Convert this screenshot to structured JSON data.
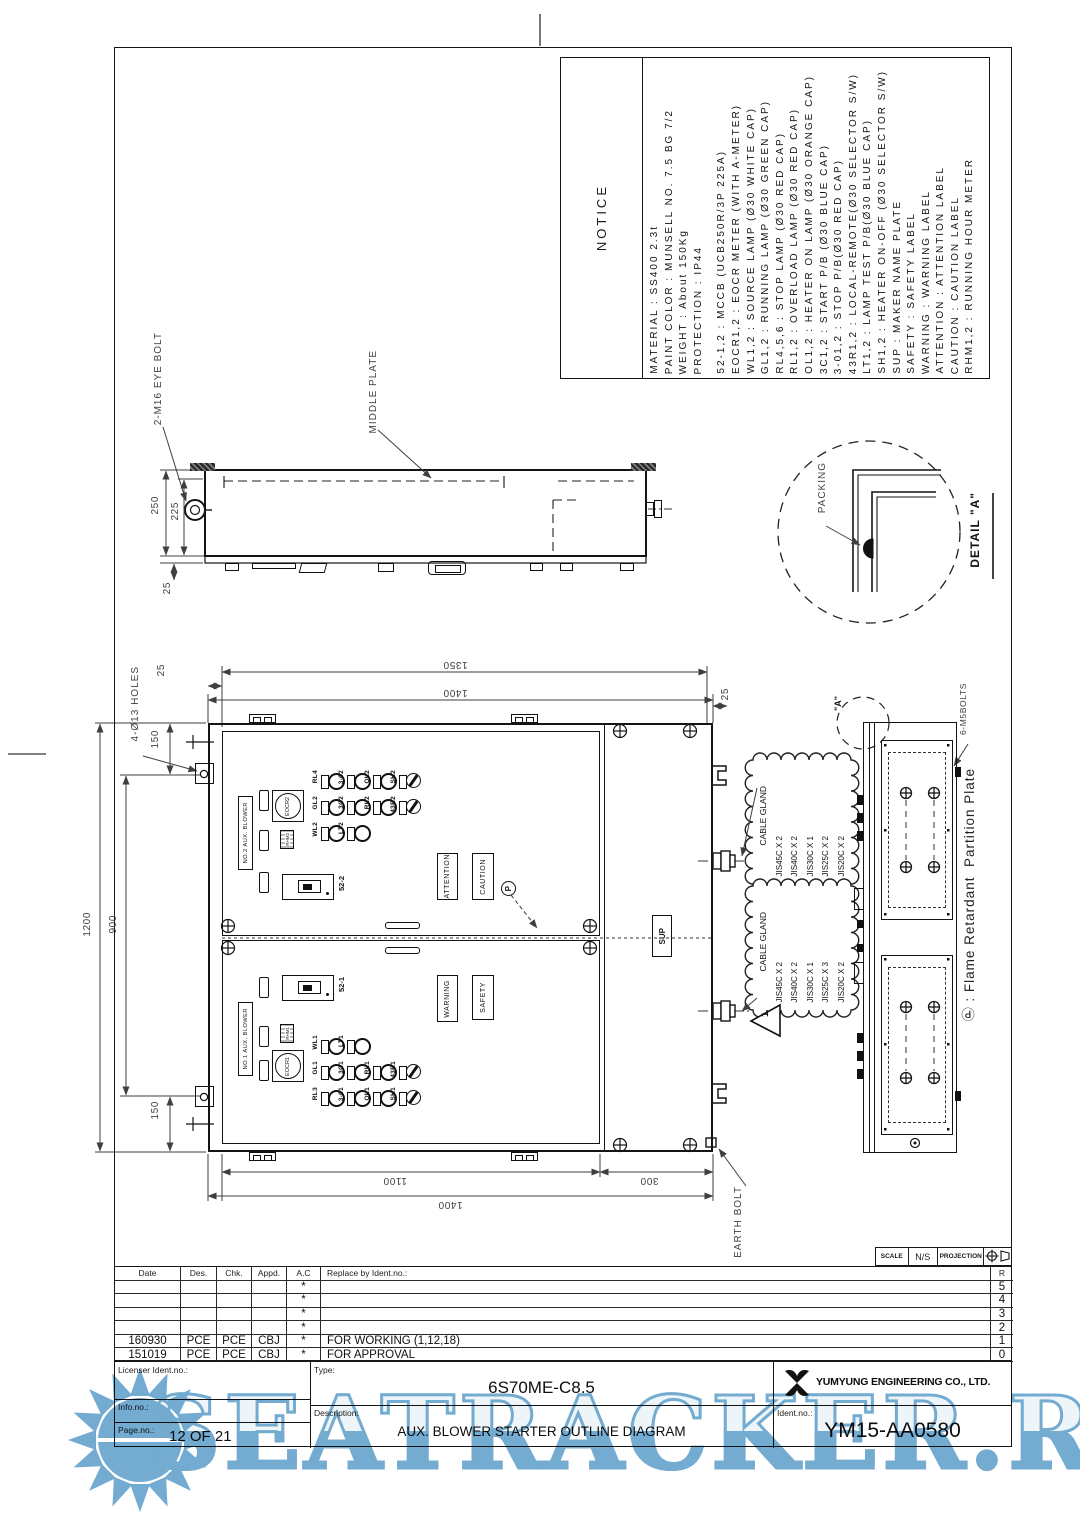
{
  "notice": {
    "title": "NOTICE",
    "lines": [
      "MATERIAL : SS400 2.3t",
      "PAINT COLOR : MUNSELL NO. 7.5 BG 7/2",
      "WEIGHT : About 150Kg",
      "PROTECTION : IP44",
      "52-1,2 : MCCB (UCB250R/3P 225A)",
      "EOCR1,2 : EOCR METER (WITH A-METER)",
      "WL1,2 : SOURCE LAMP (Ø30 WHITE CAP)",
      "GL1,2 : RUNNING LAMP (Ø30 GREEN CAP)",
      "RL4,5,6 : STOP LAMP (Ø30 RED CAP)",
      "RL1,2 : OVERLOAD LAMP (Ø30 RED CAP)",
      "OL1,2 : HEATER ON LAMP (Ø30 ORANGE CAP)",
      "3C1,2 : START P/B (Ø30 BLUE CAP)",
      "3-01,2 : STOP P/B(Ø30 RED CAP)",
      "43R1,2 : LOCAL-REMOTE(Ø30 SELECTOR S/W)",
      "LT1,2 : LAMP TEST P/B(Ø30 BLUE CAP)",
      "SH1,2 : HEATER ON-OFF (Ø30 SELECTOR S/W)",
      "SUP : MAKER NAME PLATE",
      "SAFETY : SAFETY LABEL",
      "WARNING : WARNING LABEL",
      "ATTENTION : ATTENTION LABEL",
      "CAUTION : CAUTION LABEL",
      "RHM1,2 : RUNNING HOUR METER"
    ]
  },
  "top_view": {
    "eye_bolt_label": "2-M16 EYE BOLT",
    "middle_plate_label": "MIDDLE PLATE",
    "dim_250": "250",
    "dim_225": "225",
    "dim_25": "25"
  },
  "detail_a": {
    "packing_label": "PACKING",
    "title": "DETAIL \"A\""
  },
  "front": {
    "dims": {
      "d1350": "1350",
      "d1400_top": "1400",
      "d25_left": "25",
      "d25_right": "25",
      "d150_top": "150",
      "d1200": "1200",
      "d900": "900",
      "d150_bottom": "150",
      "d1100": "1100",
      "d300": "300",
      "d1400_bottom": "1400"
    },
    "holes_note": "4-Ø13 HOLES",
    "earth_bolt_label": "EARTH BOLT",
    "a_ref": "\"A\"",
    "bolts_note": "6-M5BOLTS",
    "partition_note": "Ⓟ : Flame Retardant  Partition Plate",
    "sup_label": "SUP",
    "triangle_ref": "1",
    "p_mark": "P",
    "upper_door": {
      "nameplate": "NO.2 AUX. BLOWER",
      "eocr": "EOCR2",
      "rhm": "RHM2",
      "breaker": "52-2",
      "plate1": "ATTENTION",
      "plate2": "CAUTION",
      "lamp_rows": [
        [
          "RL4",
          "3-02",
          "OL2",
          "SH2"
        ],
        [
          "GL2",
          "3C2",
          "RL2",
          "43R2"
        ],
        [
          "WL2",
          "LT2"
        ]
      ]
    },
    "lower_door": {
      "nameplate": "NO.1 AUX. BLOWER",
      "eocr": "EOCR1",
      "rhm": "RHM1",
      "breaker": "52-1",
      "plate1": "WARNING",
      "plate2": "SAFETY",
      "lamp_rows": [
        [
          "WL1",
          "LT1"
        ],
        [
          "GL1",
          "3C1",
          "RL1",
          "43R1"
        ],
        [
          "RL3",
          "3-01",
          "OL1",
          "SH1"
        ]
      ]
    },
    "cloud_upper": {
      "title": "CABLE GLAND",
      "items": [
        "JIS45C X 2",
        "JIS40C X 2",
        "JIS30C X 1",
        "JIS25C X 2",
        "JIS20C X 2"
      ]
    },
    "cloud_lower": {
      "title": "CABLE GLAND",
      "items": [
        "JIS45C X 2",
        "JIS40C X 2",
        "JIS30C X 1",
        "JIS25C X 3",
        "JIS20C X 2"
      ]
    }
  },
  "projection": {
    "scale_label": "SCALE",
    "scale_value": "N/S",
    "projection_label": "PROJECTION"
  },
  "revision": {
    "headers": [
      "Date",
      "Des.",
      "Chk.",
      "Appd.",
      "A.C",
      "Replace by Ident.no.:"
    ],
    "index": [
      "R",
      "5",
      "4",
      "3",
      "2",
      "1",
      "0"
    ],
    "rows": [
      {
        "date": "",
        "des": "",
        "chk": "",
        "appd": "",
        "ac": "*",
        "desc": ""
      },
      {
        "date": "",
        "des": "",
        "chk": "",
        "appd": "",
        "ac": "*",
        "desc": ""
      },
      {
        "date": "",
        "des": "",
        "chk": "",
        "appd": "",
        "ac": "*",
        "desc": ""
      },
      {
        "date": "",
        "des": "",
        "chk": "",
        "appd": "",
        "ac": "*",
        "desc": ""
      },
      {
        "date": "160930",
        "des": "PCE",
        "chk": "PCE",
        "appd": "CBJ",
        "ac": "*",
        "desc": "FOR WORKING (1,12,18)"
      },
      {
        "date": "151019",
        "des": "PCE",
        "chk": "PCE",
        "appd": "CBJ",
        "ac": "*",
        "desc": "FOR APPROVAL"
      }
    ]
  },
  "title_block": {
    "licenser_label": "Licenser Ident.no.:",
    "info_label": "Info.no.:",
    "page_label": "Page.no.:",
    "page_value": "12 OF 21",
    "type_label": "Type:",
    "type_value": "6S70ME-C8.5",
    "desc_label": "Description:",
    "desc_value": "AUX. BLOWER STARTER OUTLINE DIAGRAM",
    "company": "YUMYUNG ENGINEERING CO., LTD.",
    "ident_label": "Ident.no.:",
    "ident_value": "YM15-AA0580"
  },
  "watermark": {
    "text": "SEATRACKER.RU",
    "color": "#74abd0"
  }
}
